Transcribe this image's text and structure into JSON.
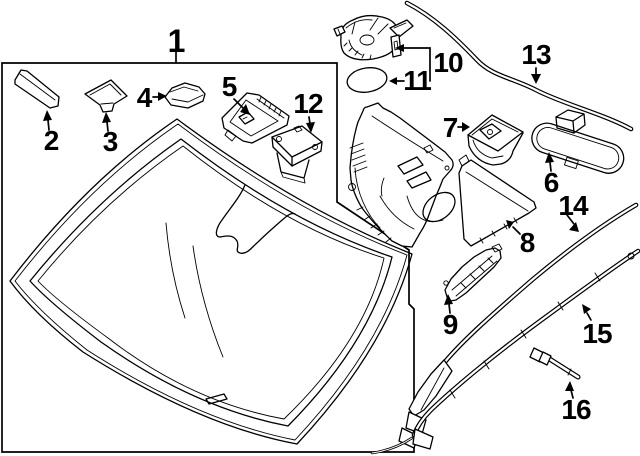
{
  "diagram": {
    "type": "exploded-parts-diagram",
    "subject": "windshield-glass-and-mouldings",
    "background_color": "#ffffff",
    "line_color": "#000000",
    "callouts": [
      {
        "label": "1"
      },
      {
        "label": "2"
      },
      {
        "label": "3"
      },
      {
        "label": "4"
      },
      {
        "label": "5"
      },
      {
        "label": "6"
      },
      {
        "label": "7"
      },
      {
        "label": "8"
      },
      {
        "label": "9"
      },
      {
        "label": "10"
      },
      {
        "label": "11"
      },
      {
        "label": "12"
      },
      {
        "label": "13"
      },
      {
        "label": "14"
      },
      {
        "label": "15"
      },
      {
        "label": "16"
      }
    ]
  }
}
